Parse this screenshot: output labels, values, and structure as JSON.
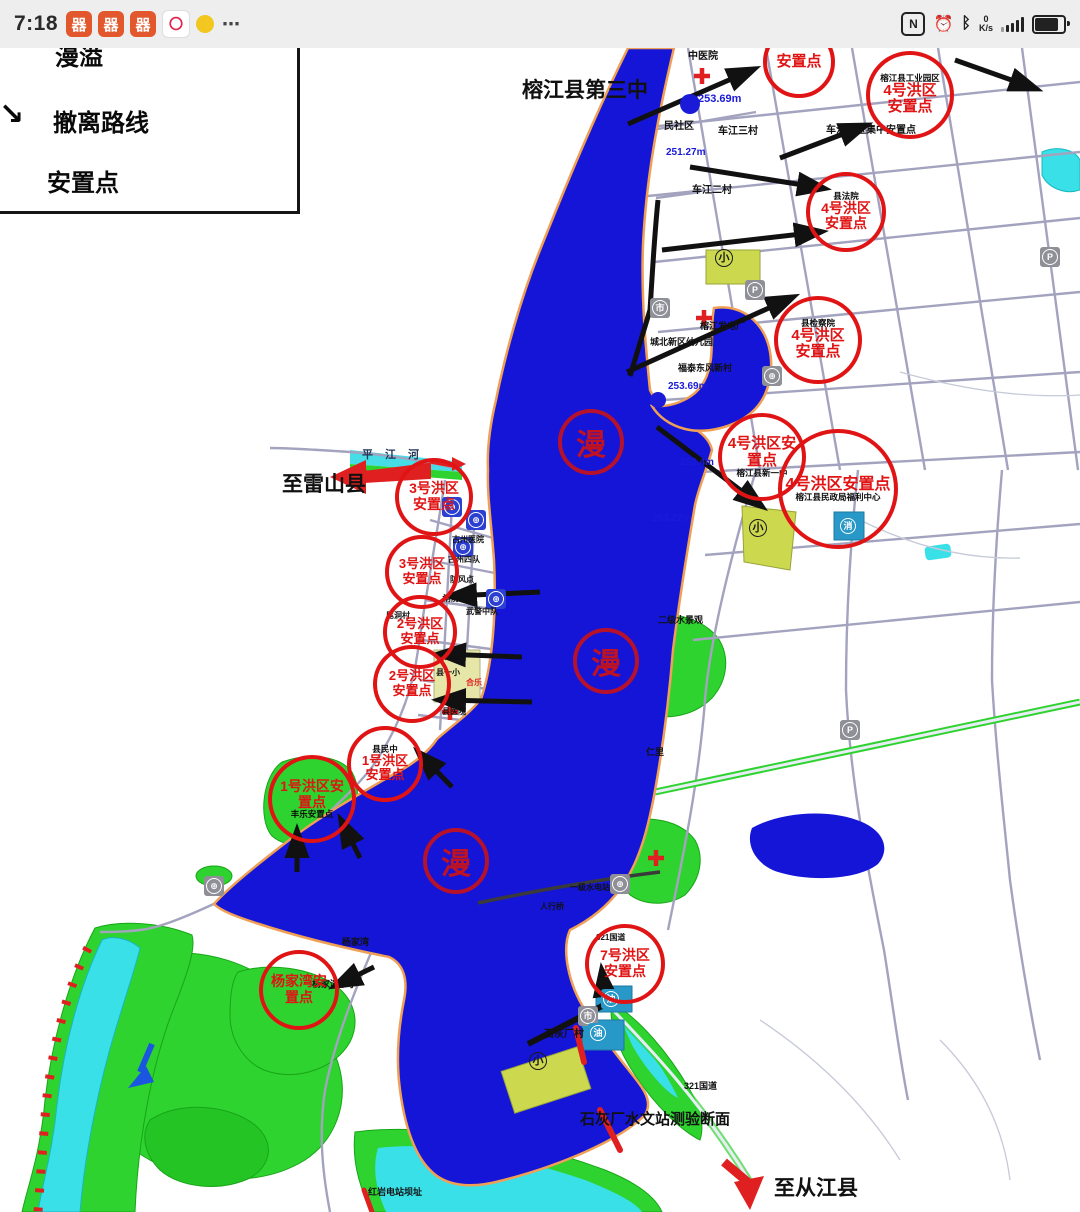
{
  "status_bar": {
    "time": "7:18",
    "app_icons": [
      {
        "glyph": "器",
        "cls": "orange"
      },
      {
        "glyph": "器",
        "cls": "orange"
      },
      {
        "glyph": "器",
        "cls": "orange"
      },
      {
        "glyph": "〇",
        "cls": "white-red"
      },
      {
        "glyph": "",
        "cls": "duck"
      }
    ],
    "ellipsis": "⋯",
    "nfc_icon": "N",
    "alarm_icon": "⏰",
    "bluetooth_icon": "ᛒ",
    "net_value": "0",
    "net_unit": "K/s"
  },
  "legend": {
    "item_overflow": "漫溢",
    "item_route": "撤离路线",
    "item_settlement": "安置点",
    "route_arrow_glyph": "↘"
  },
  "map": {
    "labels": [
      {
        "left": 522,
        "top": 80,
        "text": "榕江县第三中",
        "fs": 21,
        "fw": 700
      },
      {
        "left": 282,
        "top": 474,
        "text": "至雷山县",
        "fs": 21,
        "fw": 700
      },
      {
        "left": 774,
        "top": 1178,
        "text": "至从江县",
        "fs": 21,
        "fw": 700
      },
      {
        "left": 580,
        "top": 1112,
        "text": "石灰厂水文站测验断面",
        "fs": 15,
        "fw": 700
      },
      {
        "left": 688,
        "top": 52,
        "text": "中医院",
        "fs": 10
      },
      {
        "left": 664,
        "top": 122,
        "text": "民社区",
        "fs": 10
      },
      {
        "left": 718,
        "top": 127,
        "text": "车江三村",
        "fs": 10
      },
      {
        "left": 692,
        "top": 186,
        "text": "车江二村",
        "fs": 10
      },
      {
        "left": 826,
        "top": 126,
        "text": "车江片区集中安置点",
        "fs": 10
      },
      {
        "left": 700,
        "top": 322,
        "text": "榕江发电厂",
        "fs": 9
      },
      {
        "left": 650,
        "top": 338,
        "text": "城北新区幼儿园",
        "fs": 9
      },
      {
        "left": 678,
        "top": 364,
        "text": "福泰东风新村",
        "fs": 9
      },
      {
        "left": 658,
        "top": 616,
        "text": "二级水景观",
        "fs": 9
      },
      {
        "left": 646,
        "top": 748,
        "text": "仁里",
        "fs": 9
      },
      {
        "left": 452,
        "top": 536,
        "text": "古州医院",
        "fs": 8
      },
      {
        "left": 448,
        "top": 556,
        "text": "古州四队",
        "fs": 8
      },
      {
        "left": 450,
        "top": 576,
        "text": "防风点",
        "fs": 8
      },
      {
        "left": 443,
        "top": 595,
        "text": "消防大队",
        "fs": 8
      },
      {
        "left": 466,
        "top": 608,
        "text": "武警中队",
        "fs": 8
      },
      {
        "left": 386,
        "top": 612,
        "text": "尾洞村",
        "fs": 8
      },
      {
        "left": 436,
        "top": 653,
        "text": "社保局",
        "fs": 8
      },
      {
        "left": 436,
        "top": 669,
        "text": "县一小",
        "fs": 8
      },
      {
        "left": 442,
        "top": 708,
        "text": "县医院",
        "fs": 8
      },
      {
        "left": 466,
        "top": 679,
        "text": "合乐",
        "fs": 8,
        "color": "#e02020"
      },
      {
        "left": 544,
        "top": 1030,
        "text": "石灰厂村",
        "fs": 10
      },
      {
        "left": 596,
        "top": 934,
        "text": "321国道",
        "fs": 8
      },
      {
        "left": 684,
        "top": 1082,
        "text": "321国道",
        "fs": 9
      },
      {
        "left": 368,
        "top": 1188,
        "text": "红岩电站坝址",
        "fs": 9
      },
      {
        "left": 312,
        "top": 980,
        "text": "杨家湾小学",
        "fs": 9
      },
      {
        "left": 342,
        "top": 938,
        "text": "杨家湾",
        "fs": 9
      },
      {
        "left": 570,
        "top": 884,
        "text": "一级水电站",
        "fs": 8
      },
      {
        "left": 540,
        "top": 903,
        "text": "人行桥",
        "fs": 8
      },
      {
        "left": 362,
        "top": 450,
        "text": "平江河",
        "fs": 11,
        "ls": 12,
        "color": "#223355"
      },
      {
        "left": 698,
        "top": 94,
        "text": "253.69m",
        "fs": 11,
        "fw": 700,
        "color": "#1a1ad8"
      },
      {
        "left": 666,
        "top": 148,
        "text": "251.27m",
        "fs": 10,
        "color": "#1a1ad8"
      },
      {
        "left": 668,
        "top": 382,
        "text": "253.69m",
        "fs": 10,
        "color": "#1a1ad8"
      },
      {
        "left": 680,
        "top": 458,
        "text": "253.4m",
        "fs": 10,
        "color": "#1a1ad8"
      },
      {
        "left": 652,
        "top": 514,
        "text": "253.27m",
        "fs": 10,
        "color": "#1a1ad8"
      }
    ],
    "settlement_circles": [
      {
        "left": 763,
        "top": 26,
        "w": 72,
        "h": 72,
        "fs": 15,
        "label": "安置点"
      },
      {
        "left": 866,
        "top": 51,
        "w": 88,
        "h": 88,
        "fs": 15,
        "label": "4号洪区\n安置点",
        "note_top": "榕江县工业园区"
      },
      {
        "left": 806,
        "top": 172,
        "w": 80,
        "h": 80,
        "fs": 14,
        "label": "4号洪区\n安置点",
        "note_top": "县法院"
      },
      {
        "left": 774,
        "top": 296,
        "w": 88,
        "h": 88,
        "fs": 15,
        "label": "4号洪区\n安置点",
        "note_top": "县检察院"
      },
      {
        "left": 718,
        "top": 413,
        "w": 88,
        "h": 88,
        "fs": 15,
        "label": "4号洪区安\n置点",
        "note_bottom": "榕江县新一中"
      },
      {
        "left": 778,
        "top": 429,
        "w": 120,
        "h": 120,
        "fs": 16,
        "label": "4号洪区安置点",
        "note_bottom": "榕江县民政局福利中心"
      },
      {
        "left": 395,
        "top": 458,
        "w": 78,
        "h": 78,
        "fs": 14,
        "label": "3号洪区\n安置点"
      },
      {
        "left": 385,
        "top": 535,
        "w": 74,
        "h": 74,
        "fs": 13,
        "label": "3号洪区\n安置点"
      },
      {
        "left": 383,
        "top": 595,
        "w": 74,
        "h": 74,
        "fs": 13,
        "label": "2号洪区\n安置点"
      },
      {
        "left": 373,
        "top": 645,
        "w": 78,
        "h": 78,
        "fs": 13,
        "label": "2号洪区\n安置点"
      },
      {
        "left": 347,
        "top": 726,
        "w": 76,
        "h": 76,
        "fs": 13,
        "label": "1号洪区\n安置点",
        "note_top": "县民中"
      },
      {
        "left": 268,
        "top": 755,
        "w": 88,
        "h": 88,
        "fs": 14,
        "label": "1号洪区安\n置点",
        "note_bottom": "丰乐安置点"
      },
      {
        "left": 259,
        "top": 950,
        "w": 80,
        "h": 80,
        "fs": 14,
        "label": "杨家湾安\n置点"
      },
      {
        "left": 585,
        "top": 924,
        "w": 80,
        "h": 80,
        "fs": 14,
        "label": "7号洪区\n安置点"
      }
    ],
    "overflow_seals": [
      {
        "left": 558,
        "top": 409,
        "char": "漫"
      },
      {
        "left": 573,
        "top": 628,
        "char": "漫"
      },
      {
        "left": 423,
        "top": 828,
        "char": "漫"
      }
    ],
    "icons": [
      {
        "left": 745,
        "top": 280,
        "glyph": "P",
        "cls": "gray"
      },
      {
        "left": 1040,
        "top": 247,
        "glyph": "P",
        "cls": "gray"
      },
      {
        "left": 840,
        "top": 720,
        "glyph": "P",
        "cls": "gray"
      },
      {
        "left": 650,
        "top": 298,
        "glyph": "市",
        "cls": "gray"
      },
      {
        "left": 578,
        "top": 1006,
        "glyph": "市",
        "cls": "gray"
      },
      {
        "left": 762,
        "top": 366,
        "glyph": "⊕",
        "cls": "gray"
      },
      {
        "left": 204,
        "top": 876,
        "glyph": "⊕",
        "cls": "gray"
      },
      {
        "left": 610,
        "top": 874,
        "glyph": "⊕",
        "cls": "gray"
      },
      {
        "left": 838,
        "top": 516,
        "glyph": "消",
        "cls": "teal"
      },
      {
        "left": 601,
        "top": 989,
        "glyph": "油",
        "cls": "teal"
      },
      {
        "left": 588,
        "top": 1023,
        "glyph": "油",
        "cls": "teal"
      },
      {
        "left": 714,
        "top": 248,
        "glyph": "小",
        "cls": "school"
      },
      {
        "left": 748,
        "top": 518,
        "glyph": "小",
        "cls": "school"
      },
      {
        "left": 528,
        "top": 1051,
        "glyph": "小",
        "cls": "school"
      },
      {
        "left": 442,
        "top": 497,
        "glyph": "⊕",
        "cls": "blue"
      },
      {
        "left": 466,
        "top": 510,
        "glyph": "⊕",
        "cls": "blue"
      },
      {
        "left": 453,
        "top": 537,
        "glyph": "⊕",
        "cls": "blue"
      },
      {
        "left": 486,
        "top": 589,
        "glyph": "⊕",
        "cls": "blue"
      }
    ]
  }
}
